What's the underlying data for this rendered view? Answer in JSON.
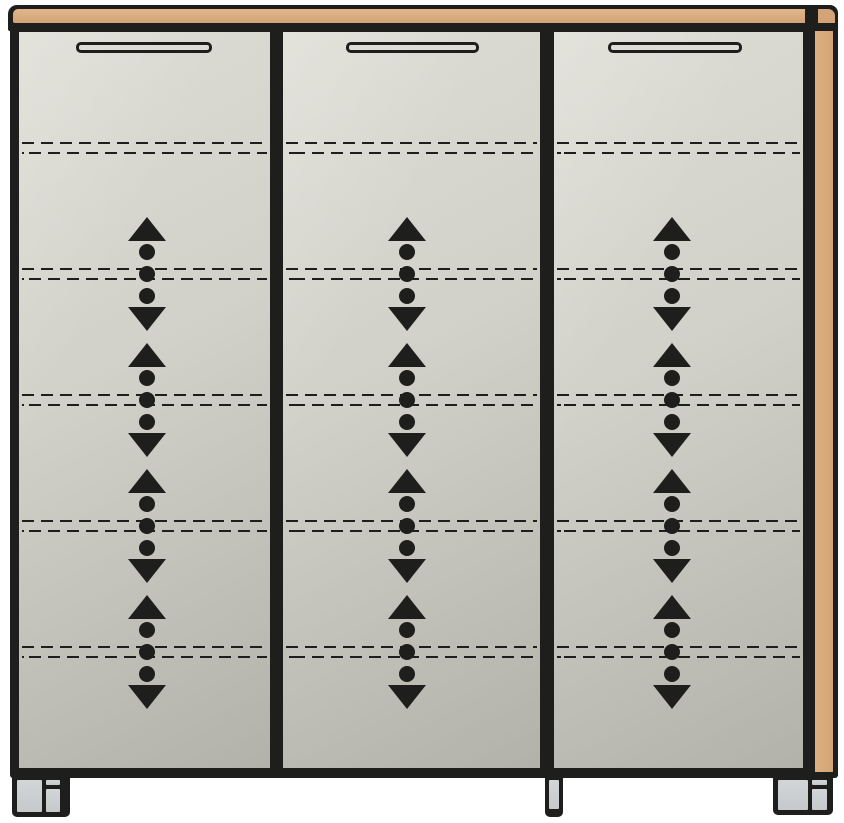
{
  "drawing": {
    "type": "furniture-front-elevation",
    "subject": "Three-door cabinet with wood top, wood right side panel, hidden adjustable shelves and feet",
    "door_count": 3,
    "shelf_count": 5,
    "adjustable_shelf_rows": 4
  },
  "colors": {
    "outline": "#1e1e1c",
    "wood": "#d2a478",
    "panel_light": "#deddd5",
    "panel_mid": "#d1d1c9",
    "panel_dark": "#b2b2aa",
    "foot_gray": "#c5c9cb",
    "background": "#ffffff"
  },
  "symbols": {
    "shelf_line": "double-dashed-line-hidden-shelf",
    "arrow_group": "up-down-arrows-with-pin-holes-height-adjustable-shelf",
    "handle": "recessed-grip-slot"
  },
  "layout": {
    "canvas": {
      "w": 844,
      "h": 823
    },
    "doors": [
      {
        "name": "left",
        "x": 19,
        "y": 32,
        "w": 251,
        "h": 736,
        "arrow_x": 147,
        "handle": {
          "x": 76,
          "y": 42,
          "w": 136,
          "h": 11
        }
      },
      {
        "name": "middle",
        "x": 283,
        "y": 32,
        "w": 257,
        "h": 736,
        "arrow_x": 407,
        "handle": {
          "x": 346,
          "y": 42,
          "w": 133,
          "h": 11
        }
      },
      {
        "name": "right",
        "x": 554,
        "y": 32,
        "w": 249,
        "h": 736,
        "arrow_x": 672,
        "handle": {
          "x": 608,
          "y": 42,
          "w": 134,
          "h": 11
        }
      }
    ],
    "shelf_lines_y": [
      148,
      274,
      400,
      526,
      652
    ],
    "arrow_groups_y": [
      274,
      400,
      526,
      652
    ],
    "feet": [
      {
        "name": "left",
        "x": 12,
        "y": 773,
        "w": 58,
        "h": 44,
        "parts": [
          {
            "x": 5,
            "y": 7,
            "w": 25,
            "h": 32
          },
          {
            "x": 34,
            "y": 7,
            "w": 14,
            "h": 5
          },
          {
            "x": 34,
            "y": 16,
            "w": 14,
            "h": 23
          }
        ]
      },
      {
        "name": "center",
        "x": 545,
        "y": 777,
        "w": 18,
        "h": 40,
        "parts": [
          {
            "x": 4,
            "y": 3,
            "w": 10,
            "h": 29
          }
        ]
      },
      {
        "name": "right",
        "x": 773,
        "y": 775,
        "w": 60,
        "h": 40,
        "parts": [
          {
            "x": 5,
            "y": 5,
            "w": 30,
            "h": 30
          },
          {
            "x": 39,
            "y": 5,
            "w": 15,
            "h": 5
          },
          {
            "x": 39,
            "y": 14,
            "w": 15,
            "h": 21
          }
        ]
      }
    ]
  }
}
